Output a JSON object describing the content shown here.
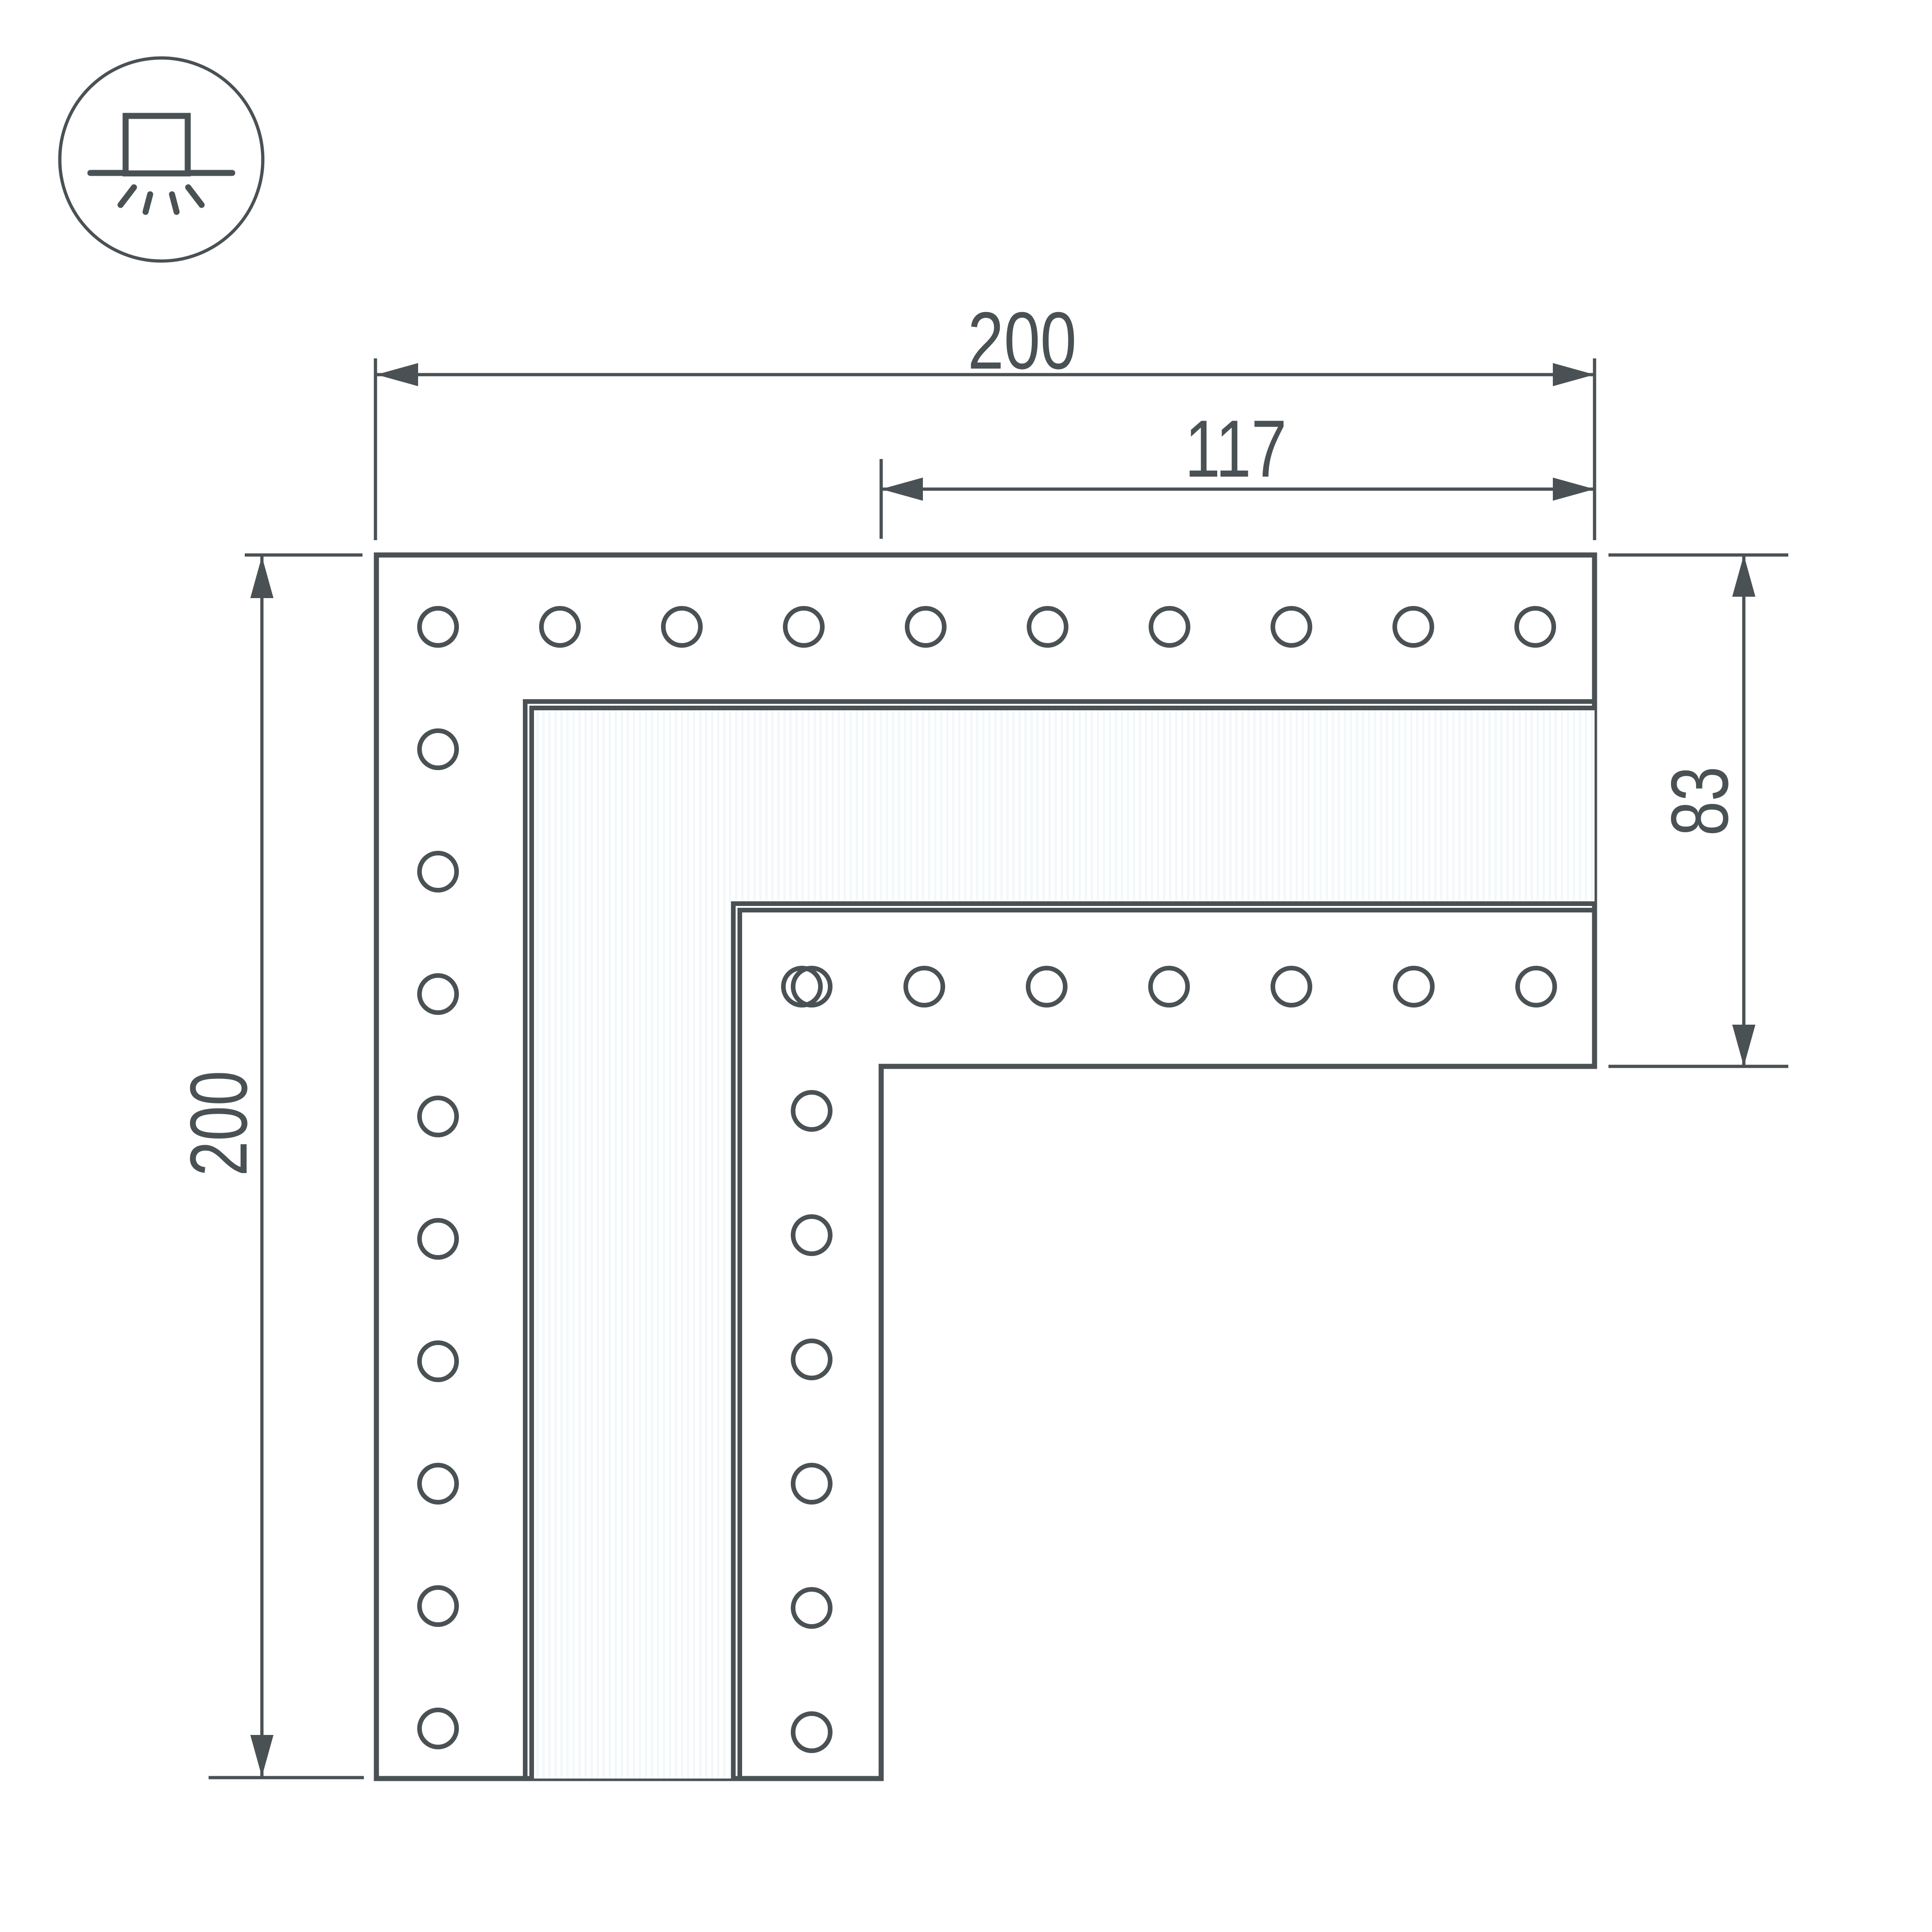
{
  "colors": {
    "ink": "#4a5154",
    "background": "#ffffff",
    "hatch": "#f3f8fa"
  },
  "icon": {
    "name": "surface-mounted-light-icon"
  },
  "dimensions": {
    "top_width": "200",
    "inner_width": "117",
    "left_height": "200",
    "right_height": "83"
  },
  "holes": {
    "style": {
      "radius": 40,
      "stroke_width": 10
    },
    "groups": [
      {
        "name": "top-row",
        "count": 10,
        "cx_start": 945,
        "cx_step": 263,
        "cy_start": 1352,
        "cy_step": 0
      },
      {
        "name": "left-column",
        "count": 10,
        "cx_start": 945,
        "cx_step": 0,
        "cy_start": 1352,
        "cy_step": 264
      },
      {
        "name": "inner-row",
        "count": 7,
        "cx_start": 1730,
        "cx_step": 264,
        "cy_start": 2128,
        "cy_step": 0
      },
      {
        "name": "inner-column",
        "count": 7,
        "cx_start": 1751,
        "cx_step": 0,
        "cy_start": 2128,
        "cy_step": 268
      }
    ]
  }
}
